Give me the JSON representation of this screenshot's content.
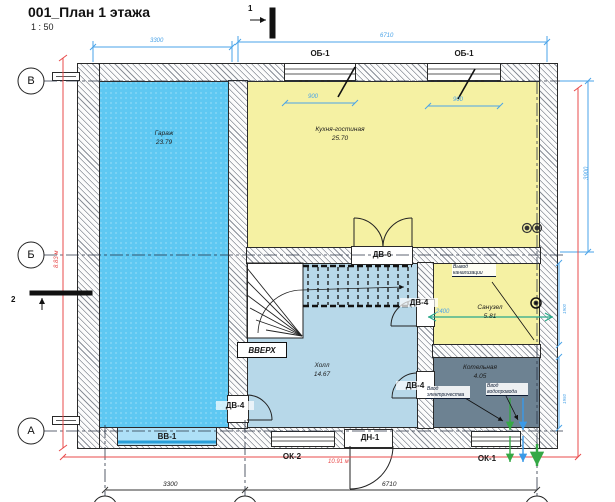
{
  "title": {
    "text": "001_План 1 этажа",
    "scale": "1 : 50"
  },
  "grid": {
    "left_axes": [
      "В",
      "Б",
      "А"
    ]
  },
  "rooms": [
    {
      "name": "Гараж",
      "area": "23.79"
    },
    {
      "name": "Кухня-гостиная",
      "area": "25.70"
    },
    {
      "name": "Холл",
      "area": "14.67"
    },
    {
      "name": "Санузел",
      "area": "5.81"
    },
    {
      "name": "Котельная",
      "area": "4.05"
    }
  ],
  "openings": {
    "window_top_left": "ОБ-1",
    "window_top_right": "ОБ-1",
    "door_hall_kitchen": "ДВ-6",
    "door_bathroom": "ДВ-4",
    "door_boiler": "ДВ-4",
    "door_garage": "ДВ-4",
    "garage_gate": "ВВ-1",
    "entry_door": "ДН-1",
    "window_bottom_left": "ОК-2",
    "window_bottom_right": "ОК-1"
  },
  "stairs": {
    "up_label": "ВВЕРХ"
  },
  "annotations": {
    "sewer_outlet": "Вывод канализации",
    "electricity_inlet": "Ввод электричества",
    "water_inlet": "Ввод водопровода"
  },
  "dimensions": {
    "top_left": "3300",
    "top_right": "6710",
    "bottom_left": "3300",
    "bottom_right": "6710",
    "overall_width": "10.91 м",
    "overall_height": "8.83 м",
    "right_span": "3900",
    "window_left": "900",
    "window_right": "900",
    "bathroom_width": "2400",
    "bathroom_height": "1900",
    "boiler_height": "1950"
  },
  "section_markers": {
    "top": "1",
    "left": "2"
  },
  "colors": {
    "garage_fill": "#5ec8f2",
    "kitchen_fill": "#f5f1a3",
    "hall_fill": "#b7d8e9",
    "bathroom_fill": "#f5f1a3",
    "boiler_fill": "#6d8292",
    "dimension_blue": "#4aa3e8",
    "dimension_red": "#e84b4b",
    "utility_green": "#35a845",
    "utility_blue": "#3a9ae8",
    "teal_line": "#2ba88a"
  }
}
